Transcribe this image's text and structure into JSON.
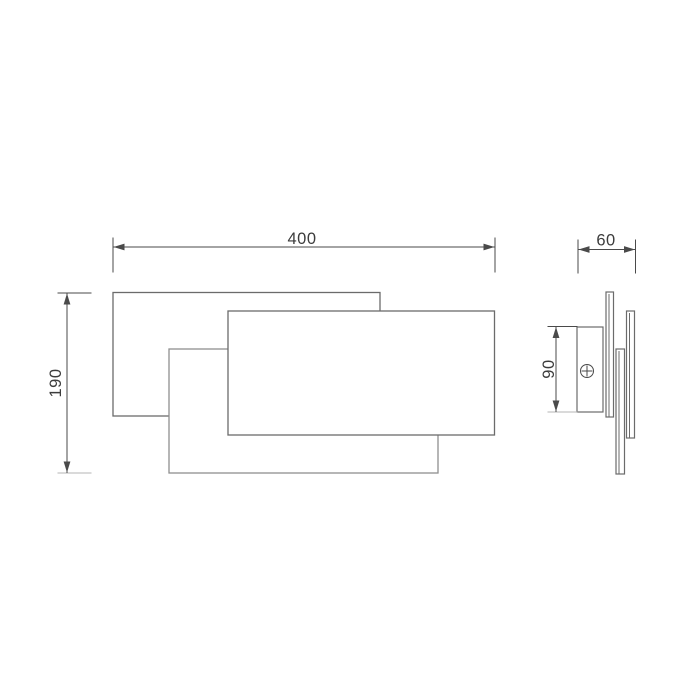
{
  "page": {
    "background": "#ffffff"
  },
  "views": {
    "front": {
      "dim_width": {
        "label": "400"
      },
      "dim_height": {
        "label": "190"
      }
    },
    "side": {
      "dim_depth": {
        "label": "60"
      },
      "dim_plate_height": {
        "label": "90"
      }
    }
  },
  "icons": {
    "screw": "phillips-screw-icon"
  },
  "colors": {
    "object_line": "#6b6b6b",
    "object_line_light": "#8f8f8f",
    "extension_light": "#b5b5b5",
    "dimension_line": "#4a4a4a",
    "label_text": "#3c3c3c",
    "fill": "#ffffff"
  }
}
